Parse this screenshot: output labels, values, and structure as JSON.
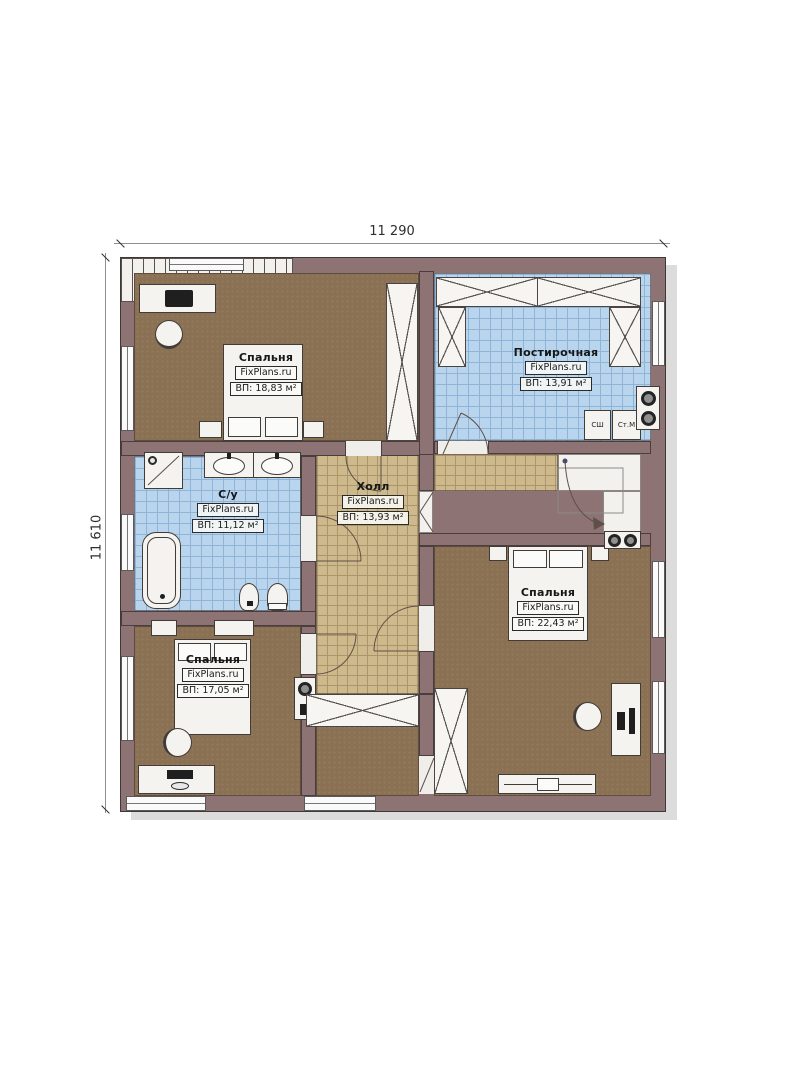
{
  "dimensions": {
    "top": "11 290",
    "left": "11 610"
  },
  "rooms": {
    "bedroom_top": {
      "name": "Спальня",
      "brand": "FixPlans.ru",
      "area": "ВП: 18,83 м²"
    },
    "laundry": {
      "name": "Постирочная",
      "brand": "FixPlans.ru",
      "area": "ВП: 13,91 м²"
    },
    "bathroom": {
      "name": "С/у",
      "brand": "FixPlans.ru",
      "area": "ВП: 11,12 м²"
    },
    "hall": {
      "name": "Холл",
      "brand": "FixPlans.ru",
      "area": "ВП: 13,93 м²"
    },
    "bedroom_right": {
      "name": "Спальня",
      "brand": "FixPlans.ru",
      "area": "ВП: 22,43 м²"
    },
    "bedroom_bottom": {
      "name": "Спальня",
      "brand": "FixPlans.ru",
      "area": "ВП: 17,05 м²"
    }
  },
  "appliances": {
    "drying_cabinet": "СШ",
    "washing_machine": "Ст.М"
  },
  "colors": {
    "wall": "#8d7373",
    "floor_brown": "#8b7153",
    "tile_blue": "#b9d5ee",
    "tile_tan": "#cdb98c",
    "outline": "#3e3a38",
    "shadow": "#dcdcdc"
  }
}
